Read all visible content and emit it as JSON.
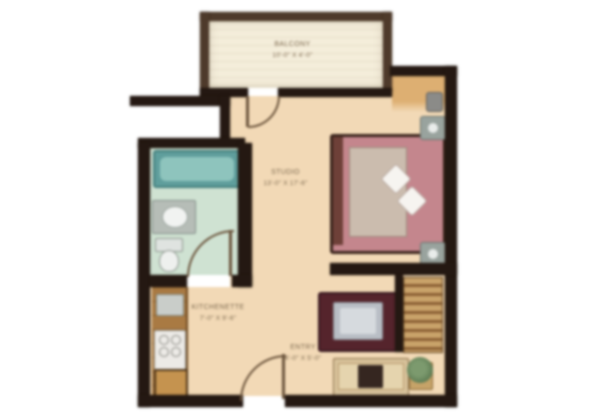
{
  "plan_title": "Studio Apartment Floor Plan",
  "rooms": {
    "balcony": {
      "name": "BALCONY",
      "dims": "10'-0\" X 4'-0\""
    },
    "studio": {
      "name": "STUDIO",
      "dims": "13'-0\" X 17'-6\""
    },
    "kitchen": {
      "name": "KITCHENETTE",
      "dims": "7'-0\" X 9'-6\""
    },
    "entry": {
      "name": "ENTRY",
      "dims": "4'-0\" X 5'-0\""
    }
  },
  "palette": {
    "wall": "#241812",
    "balcony_wall": "#4e3a2b",
    "balcony_floor": "#f4edda",
    "floor": "#f2d9b6",
    "alcove": "#ddaf72",
    "bath_floor": "#cfe2d2",
    "tub": "#5f9e9c",
    "tub_inner": "#8ec4bd",
    "counter": "#a97a43",
    "stove": "#eceae6",
    "fridge": "#c5934f",
    "bed": "#c4868d",
    "bed_duvet": "#cbbcae",
    "bed_frame": "#3a241c",
    "rug": "#55242c",
    "table": "#b9bec5",
    "sofa": "#d8c29b",
    "tv": "#352620",
    "shelf_light": "#caa36a",
    "shelf_dark": "#8a5f33",
    "plant": "#5f7d54",
    "door": "#6b543c",
    "label": "#7d6a50"
  }
}
